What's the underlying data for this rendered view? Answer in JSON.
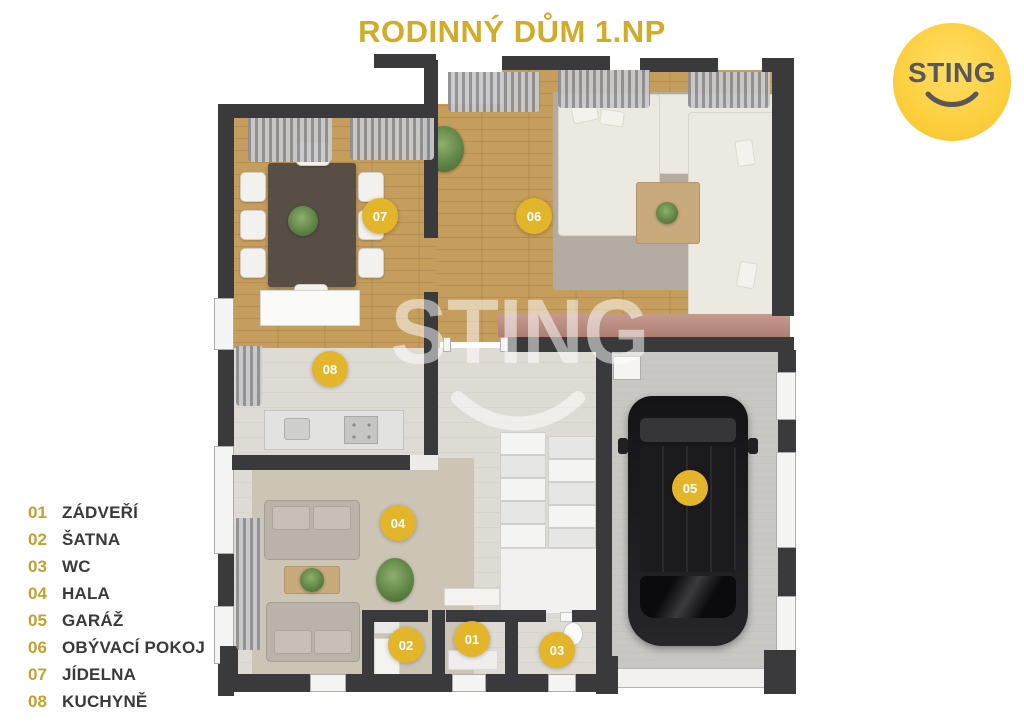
{
  "title": "RODINNÝ DŮM 1.NP",
  "logo": {
    "text": "STING"
  },
  "watermark": {
    "text": "STING"
  },
  "legend": {
    "items": [
      {
        "number": "01",
        "label": "ZÁDVEŘÍ"
      },
      {
        "number": "02",
        "label": "ŠATNA"
      },
      {
        "number": "03",
        "label": "WC"
      },
      {
        "number": "04",
        "label": "HALA"
      },
      {
        "number": "05",
        "label": "GARÁŽ"
      },
      {
        "number": "06",
        "label": "OBÝVACÍ POKOJ"
      },
      {
        "number": "07",
        "label": "JÍDELNA"
      },
      {
        "number": "08",
        "label": "KUCHYNĚ"
      }
    ]
  },
  "markers": [
    {
      "number": "07",
      "room": "JÍDELNA",
      "x": 380,
      "y": 216
    },
    {
      "number": "06",
      "room": "OBÝVACÍ POKOJ",
      "x": 534,
      "y": 216
    },
    {
      "number": "08",
      "room": "KUCHYNĚ",
      "x": 330,
      "y": 369
    },
    {
      "number": "04",
      "room": "HALA",
      "x": 398,
      "y": 523
    },
    {
      "number": "05",
      "room": "GARÁŽ",
      "x": 690,
      "y": 488
    },
    {
      "number": "02",
      "room": "ŠATNA",
      "x": 406,
      "y": 645
    },
    {
      "number": "01",
      "room": "ZÁDVEŘÍ",
      "x": 472,
      "y": 639
    },
    {
      "number": "03",
      "room": "WC",
      "x": 557,
      "y": 650
    }
  ],
  "colors": {
    "title_gold": "#D2AB28",
    "legend_number_gold": "#C2A12F",
    "marker_gold": "#E3B52B",
    "logo_yellow": "#FBCE3D",
    "logo_text_gray": "#58585C",
    "wall_dark": "#3A3A3C",
    "wood_floor": "#C59D5C"
  }
}
